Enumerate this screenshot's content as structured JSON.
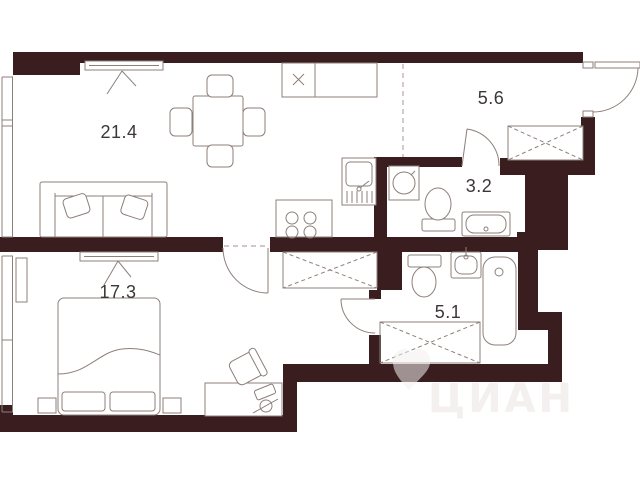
{
  "plan": {
    "type": "apartment-floor-plan",
    "rooms": [
      {
        "name": "living-kitchen",
        "area": "21.4"
      },
      {
        "name": "hallway",
        "area": "5.6"
      },
      {
        "name": "bathroom-small",
        "area": "3.2"
      },
      {
        "name": "bedroom",
        "area": "17.3"
      },
      {
        "name": "bathroom-large",
        "area": "5.1"
      }
    ],
    "watermark": "ЦИАН",
    "colors": {
      "wall": "#3a1e1f",
      "furniture_line": "#8d7f7a",
      "label": "#3c3736",
      "background": "#ffffff"
    }
  }
}
